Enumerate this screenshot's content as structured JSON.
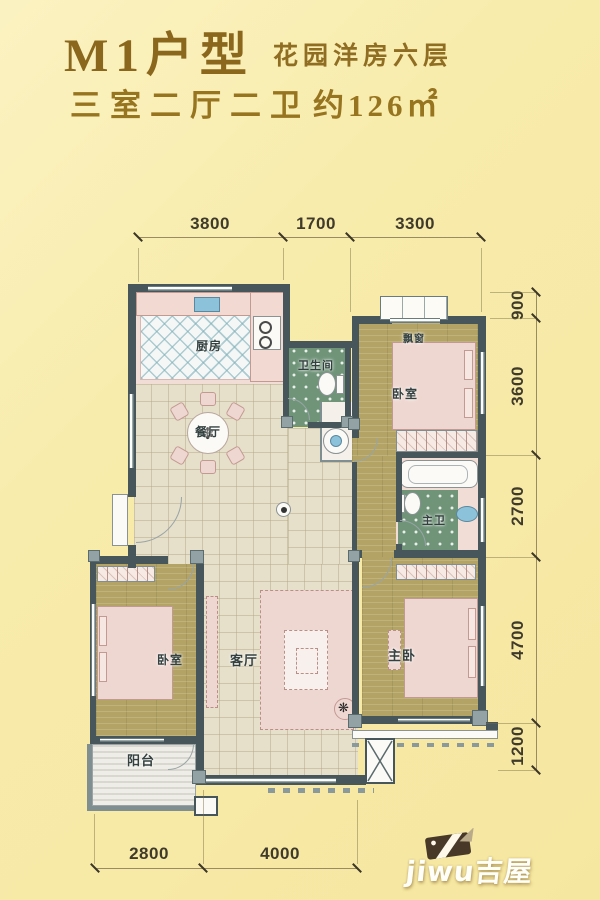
{
  "header": {
    "title": "M1户型",
    "subtitle": "花园洋房六层",
    "spec": "三室二厅二卫",
    "area": "约126㎡"
  },
  "floorplan": {
    "rooms": {
      "kitchen": "厨房",
      "dining": "餐厅",
      "bath": "卫生间",
      "bedroom_top": "卧室",
      "bay_window": "飘窗",
      "master_bath": "主卫",
      "living": "客厅",
      "bedroom_left": "卧室",
      "master_bedroom": "主卧",
      "balcony": "阳台"
    },
    "dimensions": {
      "top": [
        "3800",
        "1700",
        "3300"
      ],
      "right": [
        "900",
        "3600",
        "2700",
        "4700",
        "1200"
      ],
      "bottom": [
        "2800",
        "4000"
      ]
    },
    "symbols": {
      "table_flower": "✽",
      "plant": "❋"
    }
  },
  "watermark": {
    "text": "jiwu吉屋",
    "icon": "house-logo-icon"
  },
  "colors": {
    "background": "#f8ecac",
    "title_brown": "#8a671c",
    "wall": "#47565b",
    "wood_floor": "#b3a365",
    "tile_floor": "#e6dfca",
    "bath_green": "#6f9478",
    "furniture_pink": "#efd7d1",
    "fixture_blue": "#8cc3da"
  }
}
